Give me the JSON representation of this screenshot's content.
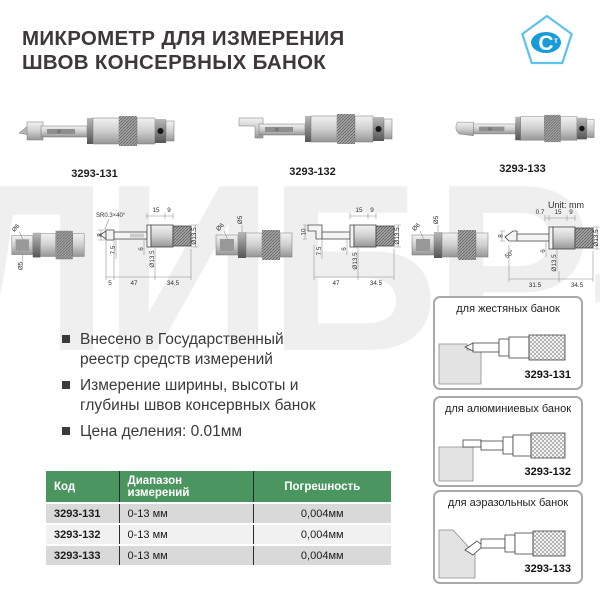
{
  "header": {
    "title_line1": "МИКРОМЕТР ДЛЯ ИЗМЕРЕНИЯ",
    "title_line2": "ШВОВ КОНСЕРВНЫХ БАНОК"
  },
  "logo": {
    "letter": "С",
    "sub_letter": "т"
  },
  "watermark": {
    "text": "ЛИБР-М"
  },
  "colors": {
    "table-green": "#4b9560",
    "logo-blue": "#189bd7",
    "logo-outline": "#5ec1ee",
    "watermark-gray": "#efefef",
    "title-color": "#3e383a"
  },
  "products": [
    {
      "code": "3293-131"
    },
    {
      "code": "3293-132"
    },
    {
      "code": "3293-133"
    }
  ],
  "drawings": {
    "unit_label": "Unit: mm",
    "end_view": {
      "dia5": "Ø5",
      "dia6": "Ø6"
    },
    "d131": {
      "sr": "SR0.3×40°",
      "t15": "15",
      "t9": "9",
      "v8": "8",
      "v75": "7.5",
      "v6": "6",
      "d135a": "Ø13.5",
      "d135b": "Ø13.5",
      "b5": "5",
      "b47": "47",
      "b345": "34.5"
    },
    "d132": {
      "v10": "10",
      "t15": "15",
      "t9": "9",
      "v75": "7.5",
      "v6": "6",
      "d135a": "Ø13.5",
      "d135b": "Ø13.5",
      "b47": "47",
      "b345": "34.5"
    },
    "d133": {
      "t07": "0.7",
      "t15": "15",
      "t9": "9",
      "v8": "8",
      "a50": "50°",
      "v6": "6",
      "d135a": "Ø13.5",
      "d135b": "Ø13.5",
      "b315": "31.5",
      "b345": "34.5"
    }
  },
  "features": [
    "Внесено в Государственный реестр средств измерений",
    "Измерение ширины, высоты и глубины швов консервных банок",
    "Цена деления: 0.01мм"
  ],
  "table": {
    "headers": [
      "Код",
      "Диапазон измерений",
      "Погрешность"
    ],
    "rows": [
      [
        "3293-131",
        "0-13 мм",
        "0,004мм"
      ],
      [
        "3293-132",
        "0-13 мм",
        "0,004мм"
      ],
      [
        "3293-133",
        "0-13 мм",
        "0,004мм"
      ]
    ]
  },
  "applications": [
    {
      "caption": "для жестяных банок",
      "code": "3293-131"
    },
    {
      "caption": "для алюминиевых банок",
      "code": "3293-132"
    },
    {
      "caption": "для аэразольных банок",
      "code": "3293-133"
    }
  ]
}
